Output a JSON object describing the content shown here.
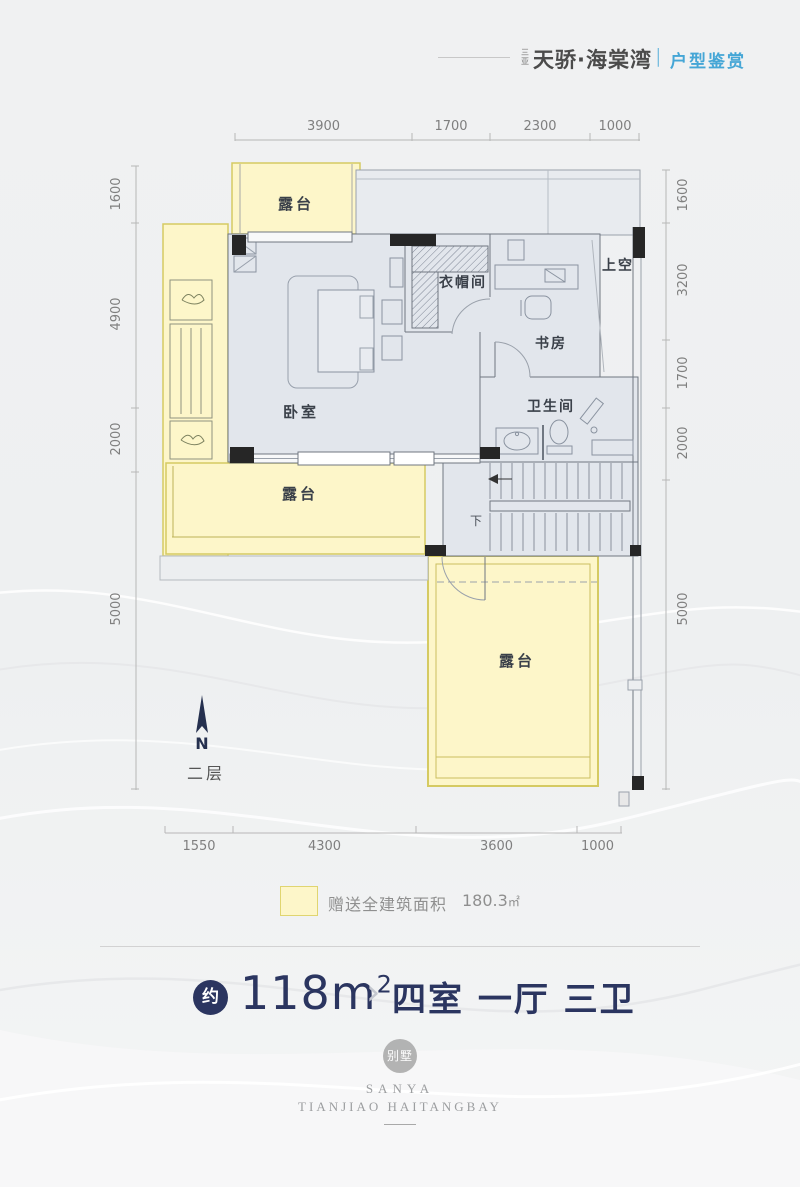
{
  "colors": {
    "accent_blue": "#45a6d6",
    "navy": "#2b3560",
    "terrace_yellow": "#fdf6c9",
    "terrace_border": "#d5ca62",
    "interior_fill": "#e2e6ec"
  },
  "header": {
    "brand_prefix": "三亚",
    "brand": "天骄·海棠湾",
    "separator": "|",
    "section": "户型鉴赏"
  },
  "plan": {
    "floor_label": "二层",
    "north_label": "N",
    "rooms": {
      "terrace_top": "露台",
      "terrace_mid": "露台",
      "terrace_bottom": "露台",
      "bedroom": "卧室",
      "cloakroom": "衣帽间",
      "study": "书房",
      "bathroom": "卫生间",
      "void_above": "上空",
      "stairs_down": "下"
    },
    "dims": {
      "top": [
        "3900",
        "1700",
        "2300",
        "1000"
      ],
      "left": [
        "1600",
        "4900",
        "2000",
        "5000"
      ],
      "right": [
        "1600",
        "3200",
        "1700",
        "2000",
        "5000"
      ],
      "bottom": [
        "1550",
        "4300",
        "3600",
        "1000"
      ]
    }
  },
  "legend": {
    "label": "赠送全建筑面积",
    "value": "180.3",
    "unit": "㎡"
  },
  "summary": {
    "approx": "约",
    "area": "118m",
    "area_sup": "2",
    "chevron": "›",
    "layout": "四室 一厅 三卫"
  },
  "watermark": {
    "badge": "别墅",
    "line1": "SANYA",
    "line2": "TIANJIAO HAITANGBAY"
  }
}
